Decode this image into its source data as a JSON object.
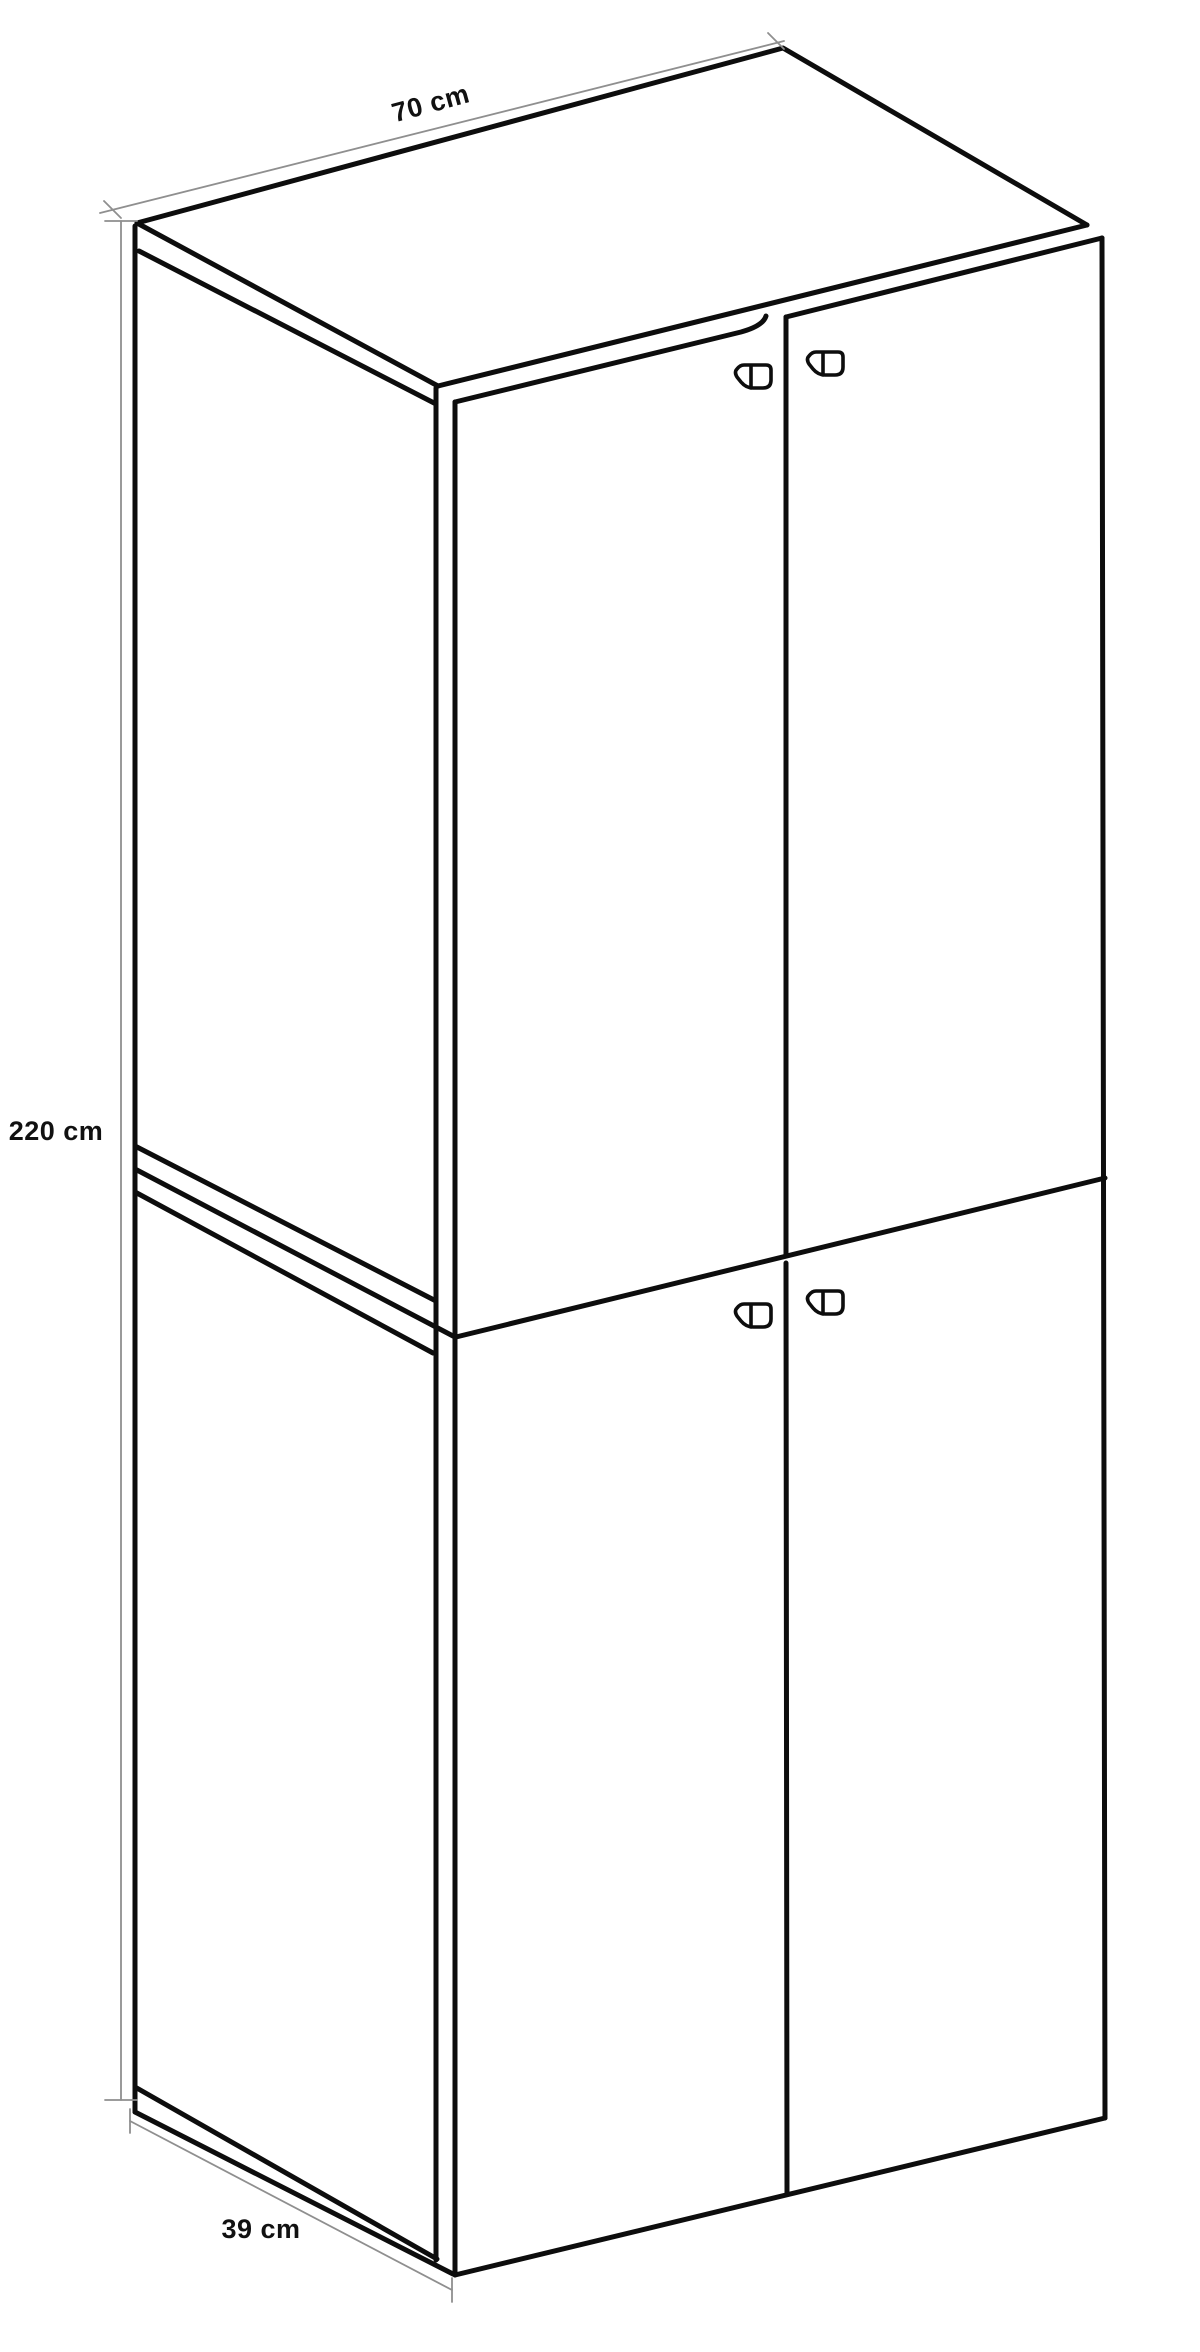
{
  "diagram": {
    "title": "cabinet-dimension-diagram",
    "product": "two-module four-door tall cabinet",
    "dimensions": {
      "width": {
        "label": "70 cm"
      },
      "height": {
        "label": "220 cm"
      },
      "depth": {
        "label": "39 cm"
      }
    },
    "colors": {
      "line": "#0d0d0d",
      "dimension": "#8f8f8f",
      "text": "#111111",
      "background": "#ffffff"
    }
  }
}
